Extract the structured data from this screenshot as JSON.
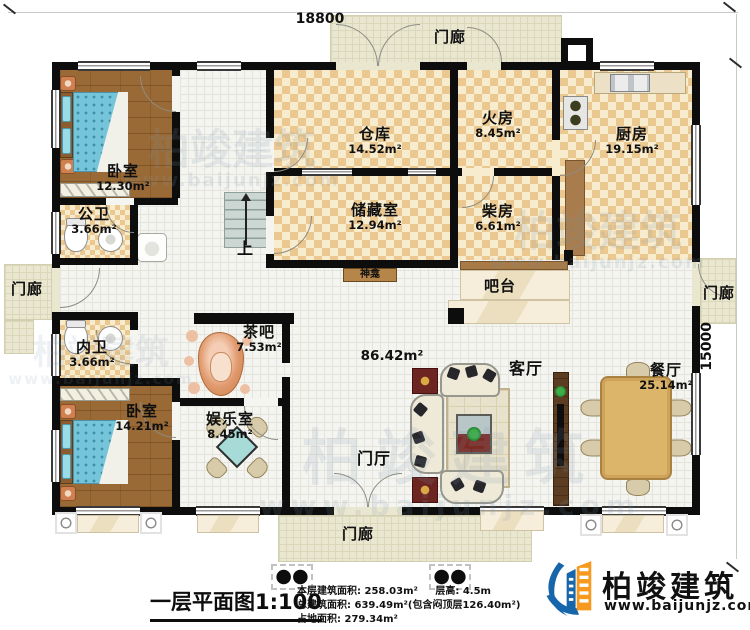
{
  "dimensions": {
    "width_label": "18800",
    "height_label": "15000"
  },
  "rooms": {
    "bedroom1": {
      "name": "卧室",
      "area": "12.30m²"
    },
    "public_bath": {
      "name": "公卫",
      "area": "3.66m²"
    },
    "warehouse": {
      "name": "仓库",
      "area": "14.52m²"
    },
    "fire_room": {
      "name": "火房",
      "area": "8.45m²"
    },
    "kitchen": {
      "name": "厨房",
      "area": "19.15m²"
    },
    "storage": {
      "name": "储藏室",
      "area": "12.94m²"
    },
    "firewood_room": {
      "name": "柴房",
      "area": "6.61m²"
    },
    "shrine": {
      "name": "神龛"
    },
    "bar": {
      "name": "吧台"
    },
    "tea_bar": {
      "name": "茶吧",
      "area": "7.53m²"
    },
    "private_bath": {
      "name": "内卫",
      "area": "3.66m²"
    },
    "hall": {
      "area": "86.42m²"
    },
    "living_room": {
      "name": "客厅"
    },
    "dining_room": {
      "name": "餐厅",
      "area": "25.14m²"
    },
    "bedroom2": {
      "name": "卧室",
      "area": "14.21m²"
    },
    "entertainment": {
      "name": "娱乐室",
      "area": "8.45m²"
    },
    "foyer": {
      "name": "门厅"
    },
    "porch_top": {
      "name": "门廊"
    },
    "porch_left": {
      "name": "门廊"
    },
    "porch_right": {
      "name": "门廊"
    },
    "porch_bottom": {
      "name": "门廊"
    }
  },
  "stairs": {
    "up_label": "上"
  },
  "title": {
    "text": "一层平面图",
    "scale": "1:100"
  },
  "stats": {
    "floor_area": "本层建筑面积: 258.03m²",
    "floor_height": "层高: 4.5m",
    "total_area": "总建筑面积: 639.49m²(包含闷顶层126.40m²)",
    "footprint": "占地面积: 279.34m²"
  },
  "brand": {
    "name": "柏竣建筑",
    "website": "www.baijunjz.com"
  },
  "watermark": {
    "text": "柏竣建筑",
    "website": "www.baijunjz.com"
  },
  "colors": {
    "wall": "#0d0d0d",
    "checker_floor": "#ecc891",
    "wood_floor": "#9a6a36",
    "porch_floor": "#eae7d1",
    "tile_floor": "#f4f4f0",
    "bed_blue": "#74c4da",
    "brand_blue": "#1766ab",
    "brand_orange": "#f59a1e",
    "accent_red": "#6d2522",
    "counter_marble": "#f2e7cd"
  }
}
